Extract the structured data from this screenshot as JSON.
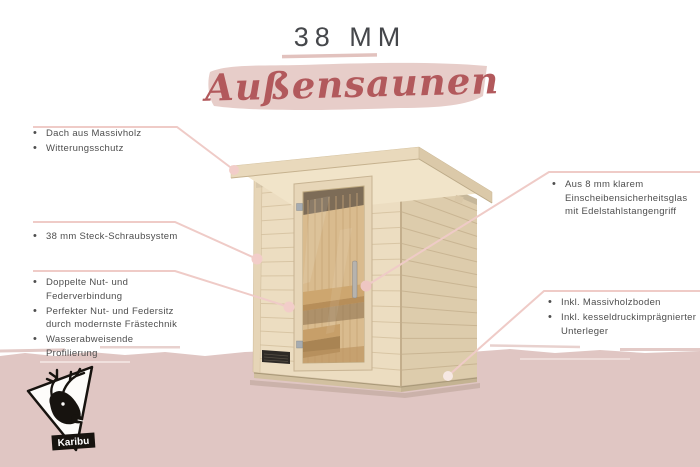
{
  "header": {
    "thickness": "38 MM",
    "banner": "Außensaunen"
  },
  "callouts": {
    "left": [
      {
        "items": [
          "Dach aus Massivholz",
          "Witterungsschutz"
        ]
      },
      {
        "items": [
          "38 mm Steck-Schraubsystem"
        ]
      },
      {
        "items": [
          "Doppelte Nut- und Federverbindung",
          "Perfekter Nut- und Federsitz durch modernste Frästechnik",
          "Wasserabweisende Profilierung"
        ]
      }
    ],
    "right": [
      {
        "items": [
          "Aus 8 mm klarem Einscheibensicherheitsglas mit Edelstahlstangengriff"
        ]
      },
      {
        "items": [
          "Inkl. Massivholzboden",
          "Inkl. kesseldruckimprägnierter Unterleger"
        ]
      }
    ]
  },
  "logo": {
    "brand": "Karibu"
  },
  "colors": {
    "background_pink": "#e0c6c3",
    "banner_pink": "#e7cdc9",
    "line_pink": "#efcbc7",
    "script_red": "#b2595c",
    "title_gray": "#45474b",
    "text_gray": "#4e4e4e",
    "wood_front": "#ecddc1",
    "wood_side": "#ddccac"
  }
}
